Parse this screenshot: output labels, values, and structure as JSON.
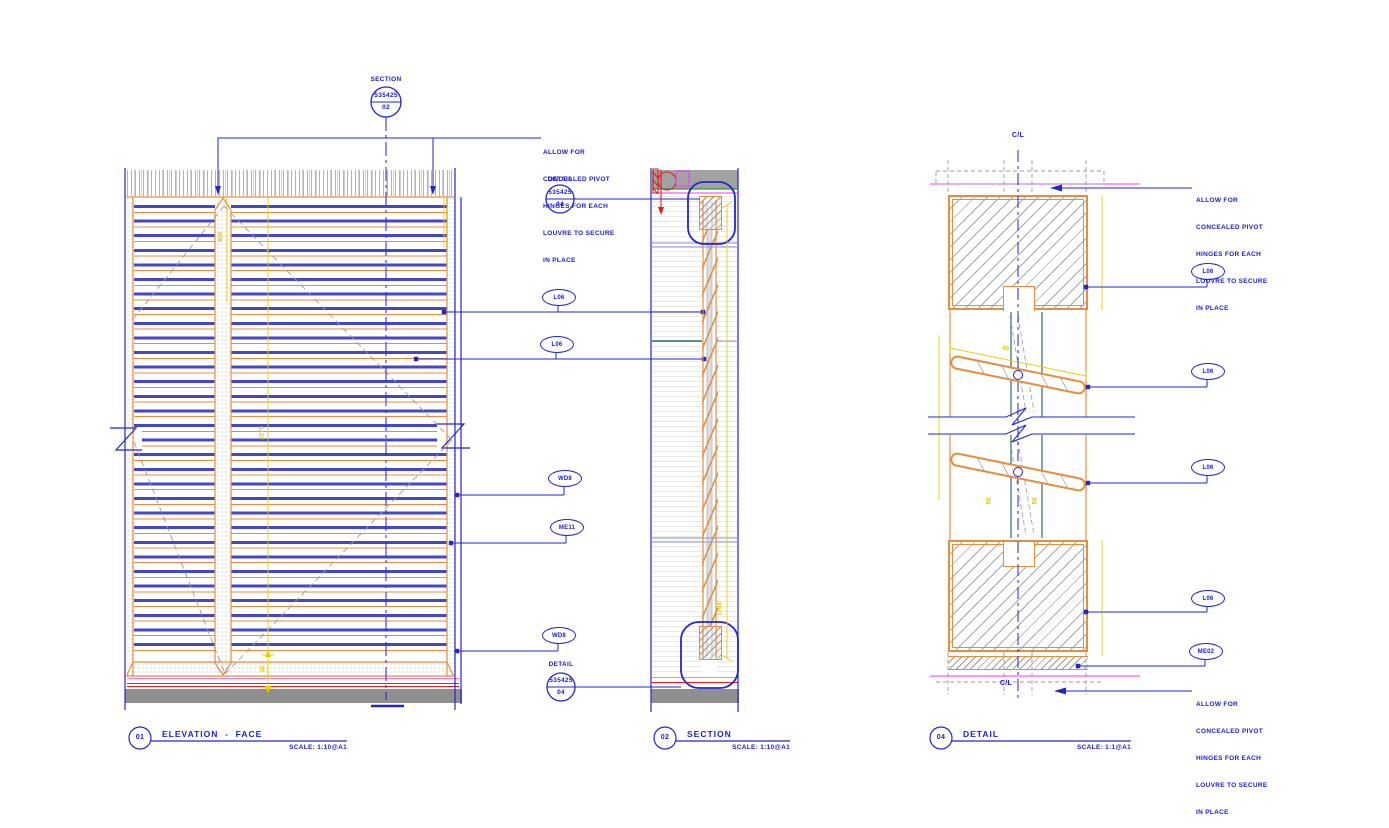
{
  "note": {
    "lines": [
      "ALLOW FOR",
      "CONCEALED PIVOT",
      "HINGES FOR EACH",
      "LOUVRE TO SECURE",
      "IN PLACE"
    ]
  },
  "markers": {
    "section": {
      "type": "SECTION",
      "number": "535425",
      "sheet": "02"
    },
    "detail_top": {
      "type": "DETAIL",
      "number": "535425",
      "sheet": "04"
    },
    "detail_bottom": {
      "type": "DETAIL",
      "number": "535425",
      "sheet": "04"
    }
  },
  "tags": {
    "mid": [
      "L06",
      "L06",
      "WD8",
      "ME11",
      "WD8"
    ],
    "right": [
      "L06",
      "L06",
      "L06",
      "L06",
      "ME02"
    ]
  },
  "centerline": {
    "label": "C/L"
  },
  "dimensions": {
    "mullion": "600",
    "elev_height": "2270",
    "elev_bottom": "30",
    "section_height": "1704",
    "blade": "40",
    "gap_a": "50",
    "gap_b": "50"
  },
  "titles": [
    {
      "num": "01",
      "title": "ELEVATION  -  FACE",
      "scale": "SCALE: 1:10@A1"
    },
    {
      "num": "02",
      "title": "SECTION",
      "scale": "SCALE: 1:10@A1"
    },
    {
      "num": "04",
      "title": "DETAIL",
      "scale": "SCALE: 1:1@A1"
    }
  ],
  "colors": {
    "blue": "#2525c8",
    "orange": "#e09040",
    "yellow": "#e3d200",
    "magenta": "#ff30ff",
    "pink": "#ff7ad2",
    "red": "#e02020",
    "teal": "#2e6b6b",
    "gray_band": "#8f8f8f"
  }
}
